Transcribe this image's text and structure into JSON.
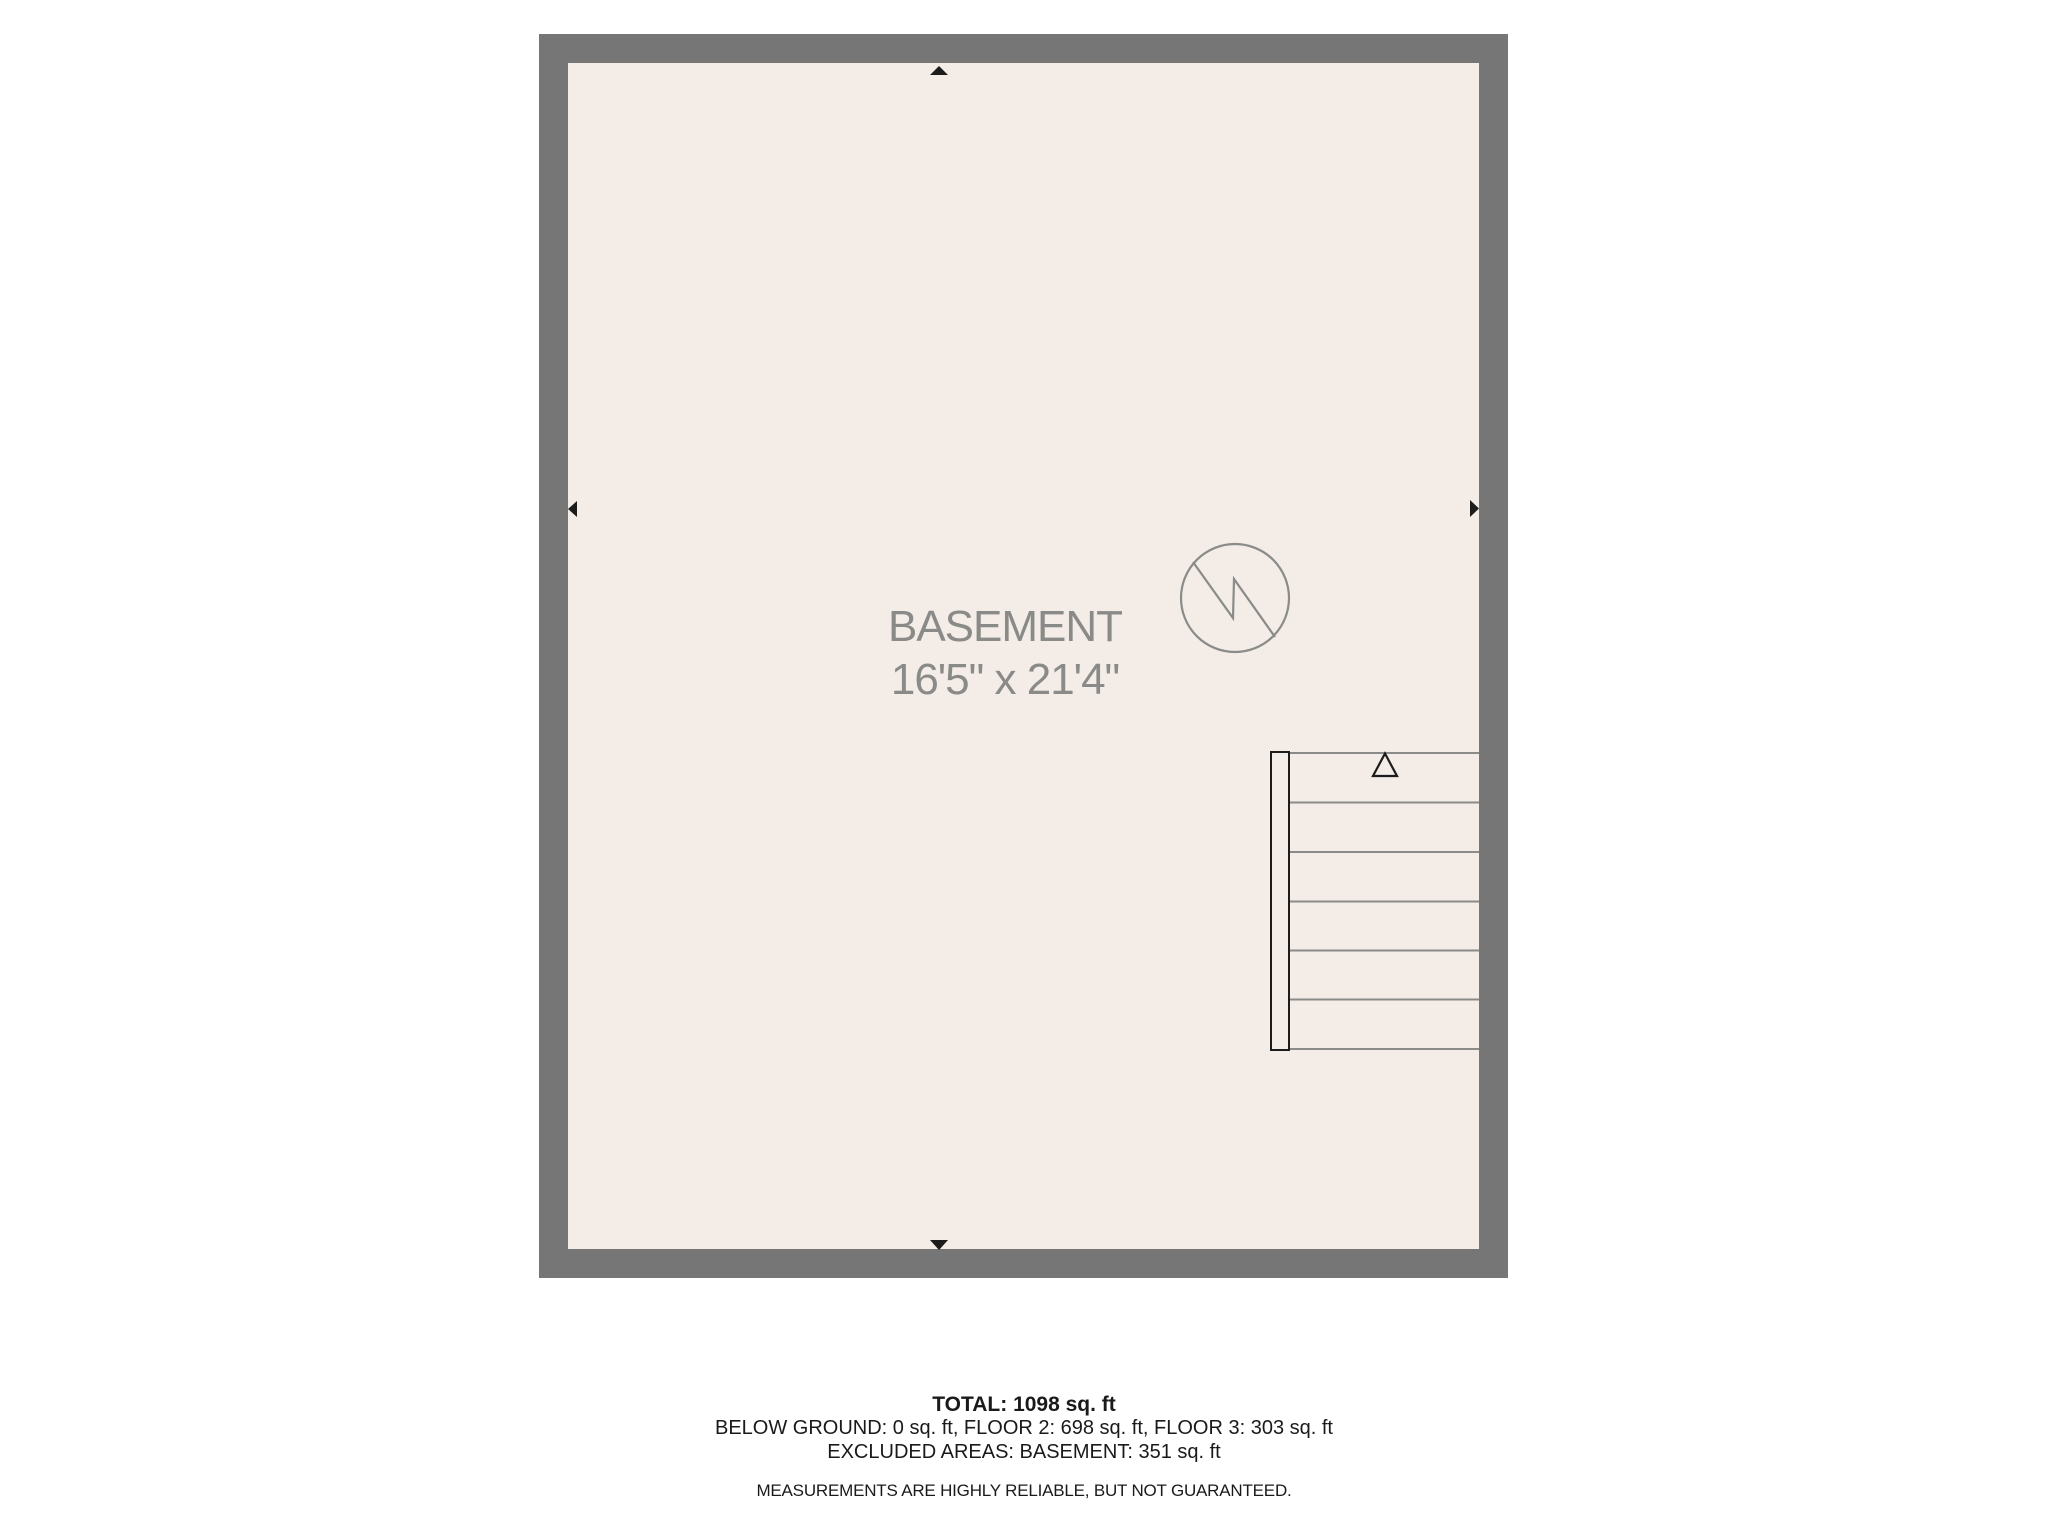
{
  "floor_plan": {
    "room": {
      "name": "BASEMENT",
      "dimensions": "16'5\" x 21'4\""
    },
    "icons": {
      "compass": "north-arrow-icon",
      "stairs_direction": "up-triangle-icon",
      "wall_markers": [
        "arrow-up-icon",
        "arrow-left-icon",
        "arrow-right-icon",
        "arrow-down-icon"
      ]
    },
    "colors": {
      "wall": "#767676",
      "floor": "#f3ece7",
      "plan_line": "#8b8b89",
      "label_text": "#8a8a88",
      "marker": "#1c1c1c",
      "summary_text": "#1a1a1a"
    }
  },
  "summary": {
    "total": "TOTAL: 1098 sq. ft",
    "floors": "BELOW GROUND: 0 sq. ft, FLOOR 2: 698 sq. ft, FLOOR 3: 303 sq. ft",
    "excluded": "EXCLUDED AREAS: BASEMENT: 351 sq. ft",
    "disclaimer": "MEASUREMENTS ARE HIGHLY RELIABLE, BUT NOT GUARANTEED."
  }
}
